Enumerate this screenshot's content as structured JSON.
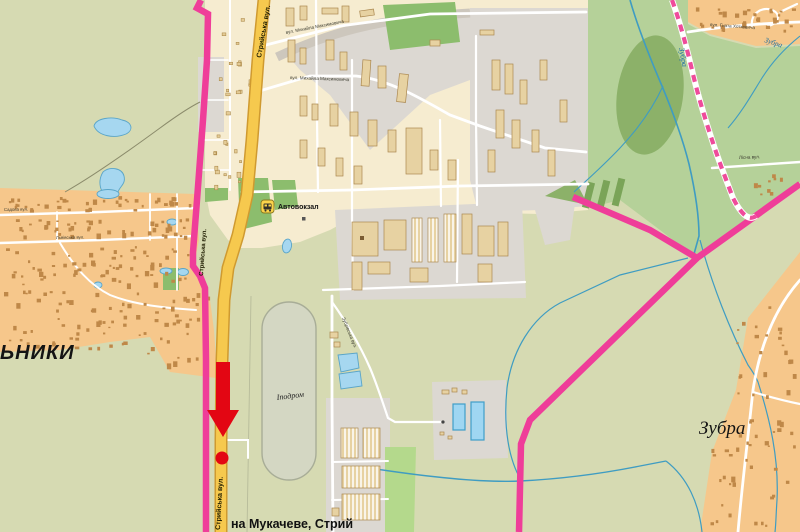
{
  "labels": {
    "street_main_top": {
      "text": "Стрийська вул."
    },
    "street_main_mid": {
      "text": "Стрийська вул."
    },
    "street_main_bottom": {
      "text": "Стрийська вул."
    },
    "street_maksymovycha_upper": {
      "text": "вул. Михайла Максимовича"
    },
    "street_maksymovycha_lower": {
      "text": "вул. Михайла Максимовича"
    },
    "street_sadova": {
      "text": "Садова вул."
    },
    "street_lvivska": {
      "text": "Львівська вул."
    },
    "street_khotkevycha": {
      "text": "вул. Гната Хоткевича"
    },
    "street_lisna": {
      "text": "Лісна вул."
    },
    "street_zubrivska": {
      "text": "Зубрівська вул."
    },
    "poi_avtovokzal": {
      "text": "Автовокзал"
    },
    "poi_ipodrom": {
      "text": "Іподром"
    },
    "district_partial": {
      "text": "ЬНИКИ"
    },
    "village_zubra": {
      "text": "Зубра"
    },
    "river_zubra_upper": {
      "text": "Зубра"
    },
    "river_zubra_corner": {
      "text": "Зубра"
    },
    "direction_sign": {
      "text": "на Мукачеве, Стрий"
    }
  },
  "marker": {
    "type": "red-arrow-down-with-dot",
    "color": "#e30613",
    "target_street": "Стрийська вул."
  },
  "icons": {
    "bus_station": {
      "name": "bus-station-icon",
      "background": "#fbd34b"
    }
  },
  "colors": {
    "field_green": "#d6dab2",
    "residential_orange": "#f6c78b",
    "city_cream": "#f6ecd0",
    "industrial_gray": "#dcd8d2",
    "park_green": "#8cbd6d",
    "forest_green": "#b5d199",
    "main_road_yellow": "#f6c94e",
    "boundary_pink": "#ef3d99",
    "water_blue": "#a6d7f0",
    "marker_red": "#e30613"
  }
}
